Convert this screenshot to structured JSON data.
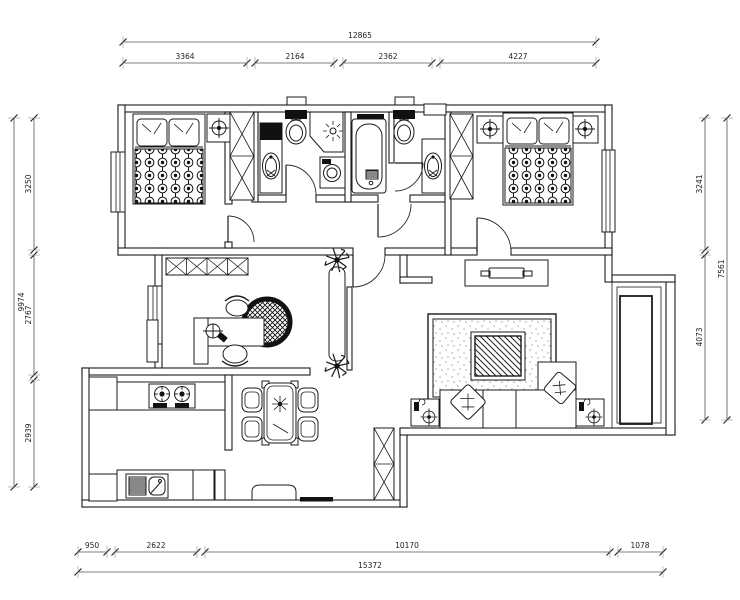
{
  "drawing": {
    "type": "apartment-floor-plan",
    "dimensions": {
      "top": {
        "total": "12865",
        "segments": [
          "3364",
          "2164",
          "2362",
          "4227"
        ]
      },
      "left": {
        "total": "9974",
        "segments": [
          "3250",
          "2767",
          "2939"
        ]
      },
      "right": {
        "total": "7561",
        "segments": [
          "3241",
          "4073"
        ]
      },
      "bottom": {
        "total": "15372",
        "segments": [
          "950",
          "2622",
          "10170",
          "1078"
        ]
      }
    },
    "symbols": [
      "double-bed",
      "pillow",
      "wardrobe-x",
      "nightstand-lamp",
      "toilet",
      "washbasin-counter",
      "bathtub",
      "washing-machine",
      "corner-shower",
      "desk-with-computer",
      "office-chair",
      "round-rug",
      "bookshelf-x",
      "potted-plant",
      "hall-cabinet",
      "tv-cabinet",
      "television",
      "area-rug",
      "coffee-table",
      "corner-sofa",
      "sofa-pillow",
      "lamp-side-table",
      "gas-stove",
      "kitchen-sink",
      "kitchen-counter",
      "dining-table",
      "dining-chair",
      "entry-bench",
      "door-mat",
      "shoe-cabinet-x",
      "balcony-sliding-door",
      "window",
      "interior-door"
    ],
    "colors": {
      "line": "#1b1b1b",
      "dimension": "#555555",
      "background": "#ffffff"
    }
  }
}
